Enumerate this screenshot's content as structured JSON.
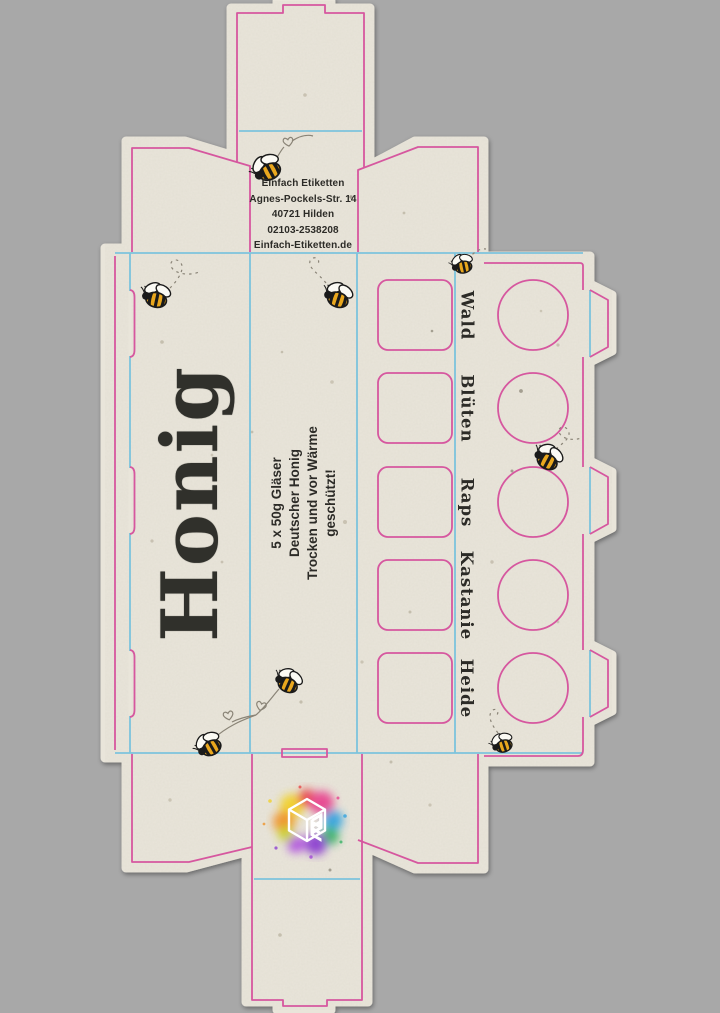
{
  "document": {
    "kind": "packaging-dieline-honey-box",
    "background_color": "#a8a8a8",
    "paper_color": "#e9e5da",
    "cut_line_color": "#d6579f",
    "fold_line_color": "#7cc3dc",
    "ink_color": "#2c2b27"
  },
  "brand_block": {
    "lines": {
      "0": "Einfach Etiketten",
      "1": "Agnes-Pockels-Str. 14",
      "2": "40721 Hilden",
      "3": "02103-2538208",
      "4": "Einfach-Etiketten.de"
    }
  },
  "front_panel": {
    "title": "Honig"
  },
  "info_panel": {
    "lines": {
      "0": "5 x 50g Gläser",
      "1": "Deutscher Honig",
      "2": "Trocken und vor Wärme",
      "3": "geschützt!"
    }
  },
  "varieties": [
    "Wald",
    "Blüten",
    "Raps",
    "Kastanie",
    "Heide"
  ],
  "decorations": {
    "bee_icon_count": 8,
    "heart_icon_count": 3,
    "window_squares": 5,
    "window_circles": 5,
    "logo": "einfach-etiketten-cube-logo"
  }
}
